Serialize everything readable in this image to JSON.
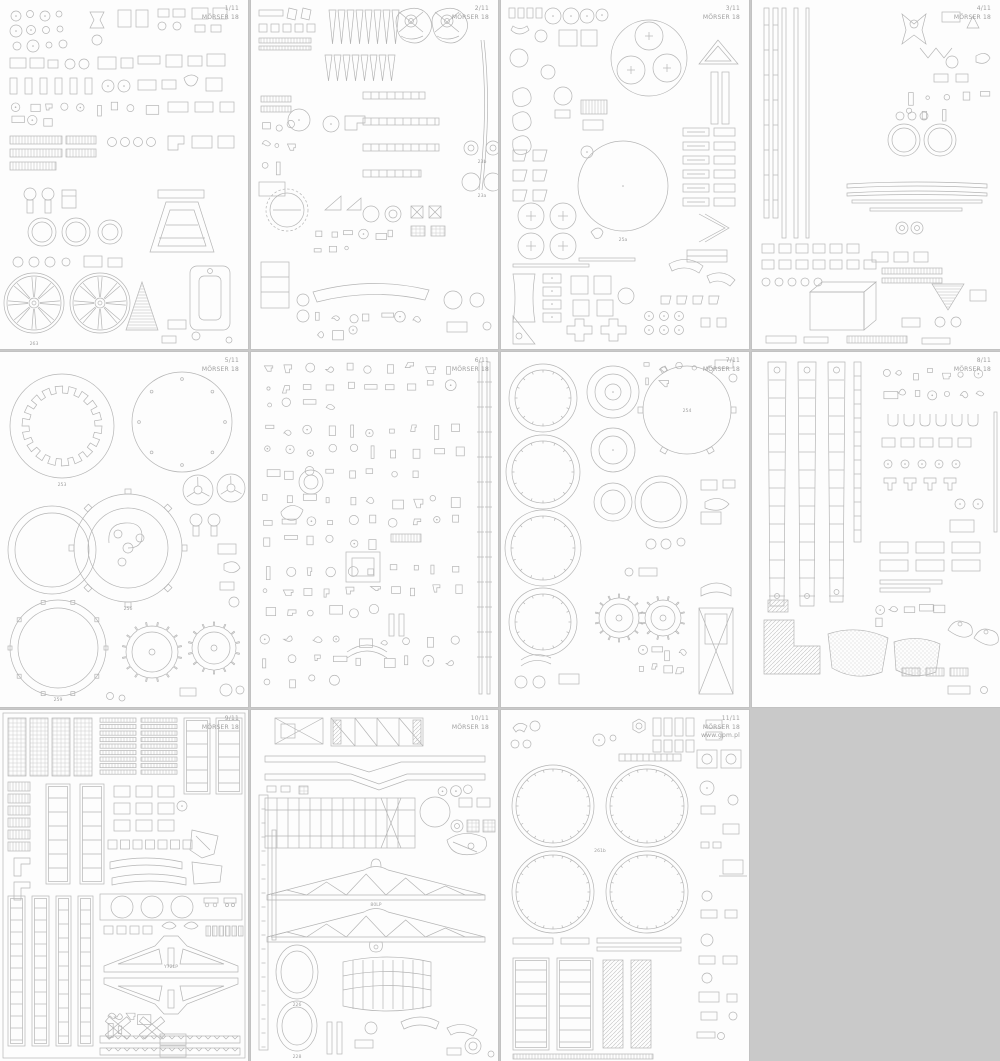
{
  "page": {
    "background_color": "#c9c9c9",
    "sheet_color": "#fdfdfd",
    "outline_color": "#b5b5b5",
    "header_text_color": "#9e9e9e"
  },
  "kit": {
    "name": "MÖRSER 18",
    "total_sheets": "11",
    "website": "www.gpm.pl"
  },
  "sheets": [
    {
      "number": "1/11",
      "title": "MÖRSER 18",
      "part_labels": [
        "263"
      ]
    },
    {
      "number": "2/11",
      "title": "MÖRSER 18",
      "part_labels": [
        "23a",
        "23b"
      ]
    },
    {
      "number": "3/11",
      "title": "MÖRSER 18",
      "part_labels": [
        "25a"
      ]
    },
    {
      "number": "4/11",
      "title": "MÖRSER 18",
      "part_labels": []
    },
    {
      "number": "5/11",
      "title": "MÖRSER 18",
      "part_labels": [
        "253",
        "256",
        "259"
      ]
    },
    {
      "number": "6/11",
      "title": "MÖRSER 18",
      "part_labels": []
    },
    {
      "number": "7/11",
      "title": "MÖRSER 18",
      "part_labels": [
        "254"
      ]
    },
    {
      "number": "8/11",
      "title": "MÖRSER 18",
      "part_labels": []
    },
    {
      "number": "9/11",
      "title": "MÖRSER 18",
      "part_labels": [
        "Y72LP"
      ]
    },
    {
      "number": "10/11",
      "title": "MÖRSER 18",
      "part_labels": [
        "80LP",
        "226",
        "228"
      ]
    },
    {
      "number": "11/11",
      "title": "MÖRSER 18",
      "website": "www.gpm.pl",
      "part_labels": [
        "261b"
      ]
    }
  ]
}
